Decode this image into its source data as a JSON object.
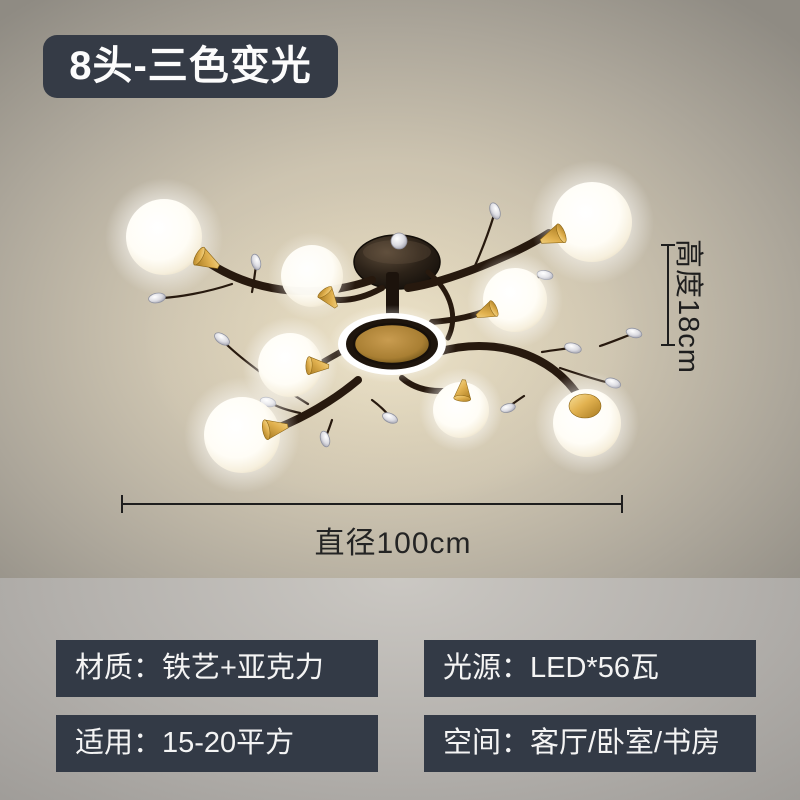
{
  "badge": {
    "label": "8头-三色变光"
  },
  "dimensions": {
    "height": "高度18cm",
    "diameter": "直径100cm"
  },
  "specs": [
    {
      "id": "material",
      "text": "材质：铁艺+亚克力"
    },
    {
      "id": "light-source",
      "text": "光源：LED*56瓦"
    },
    {
      "id": "coverage",
      "text": "适用：15-20平方"
    },
    {
      "id": "rooms",
      "text": "空间：客厅/卧室/书房"
    }
  ],
  "lamp": {
    "globe_count": 8,
    "style": "black-branch chandelier with white glass globes, gold sockets, crystal drops, amber LED ring"
  },
  "colors": {
    "badge_bg": "#353b46",
    "spec_box_bg": "#333a46",
    "text_light": "#f4f4f4",
    "dimension_ink": "#1e1e1e",
    "photo_bg_center": "#ddd3bb",
    "photo_bg_edge": "#8f8b83",
    "lower_bg": "#aaa7a3",
    "gold": "#d9a943",
    "branch": "#27190e",
    "amber_ring": "#a97f33"
  }
}
